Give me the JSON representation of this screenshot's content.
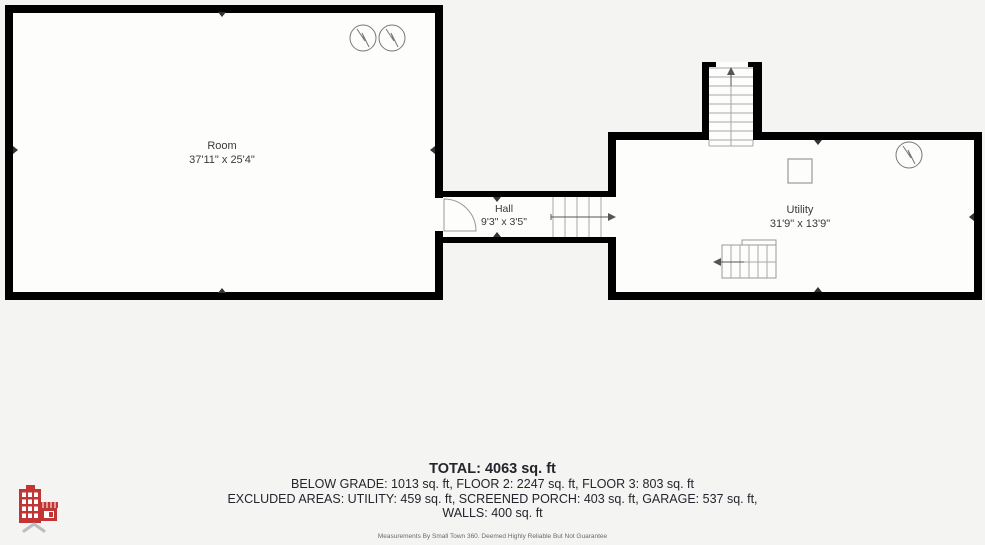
{
  "floor_plan": {
    "rooms": [
      {
        "name": "Room",
        "dimensions": "37'11\" x 25'4\""
      },
      {
        "name": "Hall",
        "dimensions": "9'3\" x 3'5\""
      },
      {
        "name": "Utility",
        "dimensions": "31'9\" x 13'9\""
      }
    ],
    "symbols": [
      "light-fixture-icon",
      "light-fixture-icon",
      "light-fixture-icon",
      "staircase-up",
      "staircase-switchback",
      "door-swing-arc",
      "column-square"
    ]
  },
  "summary": {
    "total": "TOTAL: 4063 sq. ft",
    "floors": "BELOW GRADE: 1013 sq. ft, FLOOR 2: 2247 sq. ft, FLOOR 3: 803 sq. ft",
    "excluded": "EXCLUDED AREAS: UTILITY: 459 sq. ft, SCREENED PORCH: 403 sq. ft, GARAGE: 537 sq. ft,",
    "walls": "WALLS: 400 sq. ft"
  },
  "footer": {
    "disclaimer": "Measurements By Small Town 360. Deemed Highly Reliable But Not Guarantee"
  },
  "colors": {
    "background": "#f4f4f2",
    "wall": "#000000",
    "room_fill": "#fdfdfc",
    "detail_line": "#9a9a9a",
    "logo_red": "#c23535",
    "logo_chevron": "#b9bcc0",
    "text": "#24242c"
  }
}
